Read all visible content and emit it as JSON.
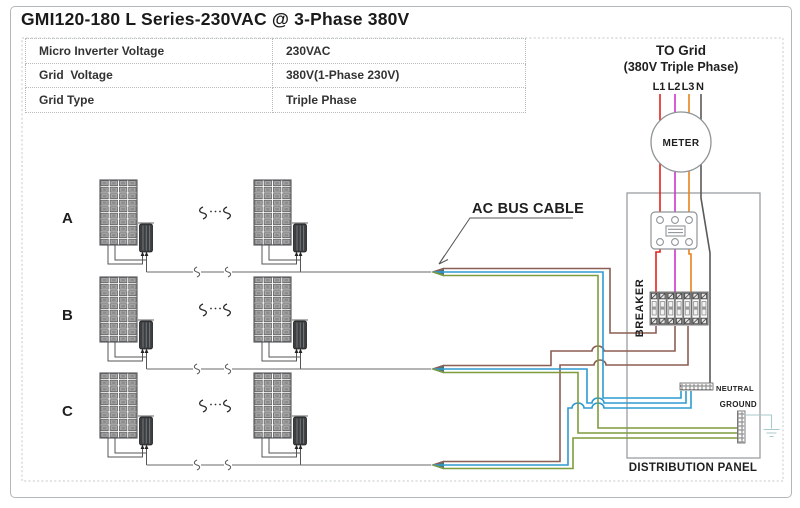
{
  "title": "GMI120-180 L Series-230VAC @ 3-Phase 380V",
  "spec_table": {
    "rows": [
      {
        "label": "Micro Inverter Voltage",
        "value": "230VAC"
      },
      {
        "label": "Grid  Voltage",
        "value": "380V(1-Phase 230V)"
      },
      {
        "label": "Grid Type",
        "value": "Triple Phase"
      }
    ]
  },
  "grid": {
    "line1": "TO Grid",
    "line2": "(380V Triple Phase)",
    "phases": [
      "L1",
      "L2",
      "L3",
      "N"
    ]
  },
  "labels": {
    "meter": "METER",
    "breaker": "BREAKER",
    "neutral": "NEUTRAL",
    "ground": "GROUND",
    "distribution_panel": "DISTRIBUTION PANEL",
    "ac_bus_cable": "AC BUS CABLE"
  },
  "rows": [
    {
      "label": "A"
    },
    {
      "label": "B"
    },
    {
      "label": "C"
    }
  ],
  "colors": {
    "l1_red": "#e2231a",
    "l2_magenta": "#cb34cb",
    "l3_orange": "#e8821e",
    "neutral_gray": "#5a5a5a",
    "line_brown": "#8b5f54",
    "neutral_blue": "#2e9bd0",
    "ground_green": "#7e9c3e",
    "earth_teal": "#a9caca",
    "bundle_tip": "#49767c"
  }
}
